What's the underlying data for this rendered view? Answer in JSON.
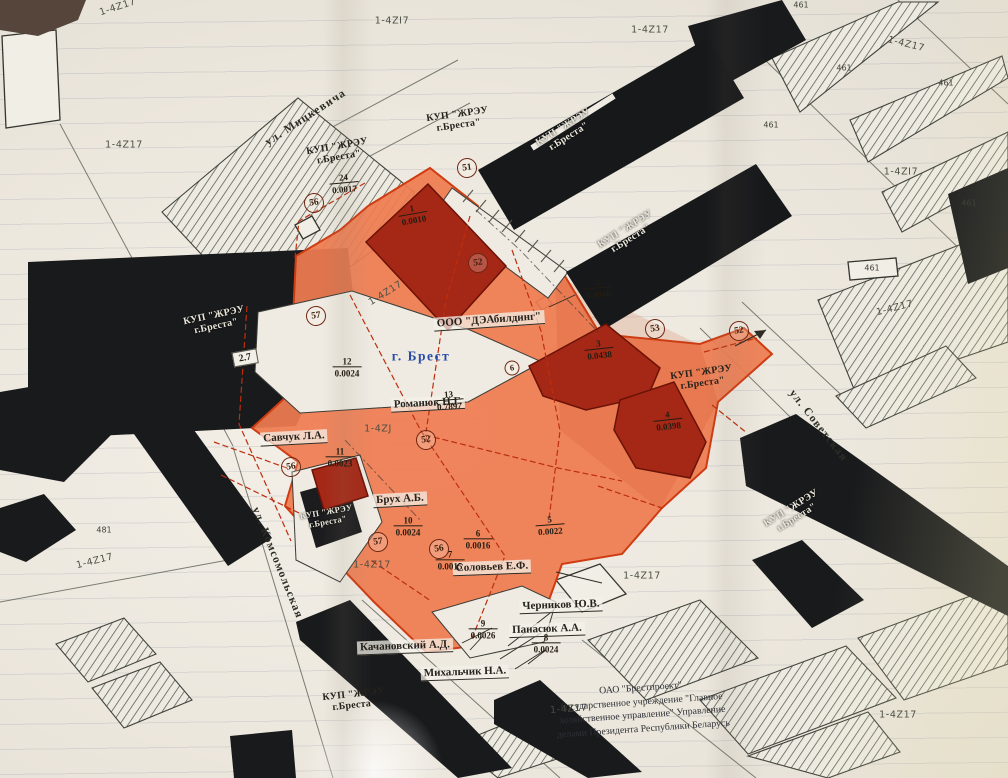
{
  "map": {
    "colors": {
      "paper": "#ece8df",
      "zone_orange": "#ef7c51",
      "zone_building_red": "#a52716",
      "black_building": "#17181a",
      "boundary_red": "#cf3c12",
      "city_blue": "#2a4da8"
    },
    "street_names": [
      {
        "text": "ул. Мицкевича",
        "x": 306,
        "y": 118,
        "rot": -33
      },
      {
        "text": "ул. Комсомольская",
        "x": 277,
        "y": 563,
        "rot": 68
      },
      {
        "text": "ул. Советская",
        "x": 818,
        "y": 426,
        "rot": 52
      }
    ],
    "kup_labels": [
      {
        "text": "КУП \"ЖРЭУ\nг.Бреста\"",
        "x": 338,
        "y": 152,
        "rot": -10,
        "on": "paper"
      },
      {
        "text": "КУП \"ЖРЭУ\nг.Бреста\"",
        "x": 458,
        "y": 120,
        "rot": -8,
        "on": "paper"
      },
      {
        "text": "КУП \"ЖРЭУ\nг.Бреста\"",
        "x": 566,
        "y": 132,
        "rot": -32,
        "on": "black"
      },
      {
        "text": "КУП \"ЖРЭУ\nг.Бреста\"",
        "x": 628,
        "y": 234,
        "rot": -32,
        "on": "black"
      },
      {
        "text": "КУП \"ЖРЭУ\nг.Бреста\"",
        "x": 215,
        "y": 321,
        "rot": -12,
        "on": "black"
      },
      {
        "text": "КУП \"ЖРЭУ\nг.Бреста\"",
        "x": 702,
        "y": 378,
        "rot": -8,
        "on": "paper"
      },
      {
        "text": "КУП \"ЖРЭУ\nг.Бреста\"",
        "x": 794,
        "y": 513,
        "rot": -32,
        "on": "black"
      },
      {
        "text": "КУП \"ЖРЭУ\nг.Бреста\"",
        "x": 327,
        "y": 517,
        "rot": -10,
        "on": "black",
        "small": true
      },
      {
        "text": "КУП \"ЖРЭУ\nг.Бреста\"",
        "x": 354,
        "y": 700,
        "rot": -6,
        "on": "paper"
      }
    ],
    "owner_labels": [
      {
        "text": "ООО \"ДЭАбилдинг\"",
        "x": 489,
        "y": 321,
        "rot": -4
      },
      {
        "text": "Романюк Н.Г.",
        "x": 428,
        "y": 404,
        "rot": -3
      },
      {
        "text": "Савчук Л.А.",
        "x": 294,
        "y": 438,
        "rot": -3
      },
      {
        "text": "Брух А.Б.",
        "x": 400,
        "y": 500,
        "rot": -3
      },
      {
        "text": "Соловьев Е.Ф.",
        "x": 492,
        "y": 568,
        "rot": -2
      },
      {
        "text": "Черников Ю.В.",
        "x": 561,
        "y": 606,
        "rot": -2
      },
      {
        "text": "Панасюк А.А.",
        "x": 547,
        "y": 630,
        "rot": -2
      },
      {
        "text": "Качановский А.Д.",
        "x": 405,
        "y": 647,
        "rot": -2
      },
      {
        "text": "Михальчик Н.А.",
        "x": 465,
        "y": 673,
        "rot": -2
      }
    ],
    "city_label": {
      "text": "г. Брест",
      "x": 421,
      "y": 356,
      "rot": 0
    },
    "zone_codes": [
      {
        "text": "1-4Z17",
        "x": 118,
        "y": 8,
        "rot": -18
      },
      {
        "text": "1-4ZI7",
        "x": 392,
        "y": 22,
        "rot": 0
      },
      {
        "text": "1-4Z17",
        "x": 650,
        "y": 31,
        "rot": 0
      },
      {
        "text": "1-4Z17",
        "x": 906,
        "y": 45,
        "rot": 14
      },
      {
        "text": "1-4Z17",
        "x": 124,
        "y": 146,
        "rot": 0
      },
      {
        "text": "1-4ZI7",
        "x": 901,
        "y": 173,
        "rot": 0
      },
      {
        "text": "1-4Z17",
        "x": 386,
        "y": 294,
        "rot": -32
      },
      {
        "text": "1-4Z17",
        "x": 895,
        "y": 309,
        "rot": -14
      },
      {
        "text": "1-4ZJ",
        "x": 378,
        "y": 430,
        "rot": 0
      },
      {
        "text": "1-4Z17",
        "x": 95,
        "y": 562,
        "rot": -14
      },
      {
        "text": "1-4Z17",
        "x": 372,
        "y": 566,
        "rot": 0
      },
      {
        "text": "1-4Z17",
        "x": 642,
        "y": 577,
        "rot": 0
      },
      {
        "text": "1-4Z17",
        "x": 569,
        "y": 710,
        "rot": -4
      },
      {
        "text": "1-4Z17",
        "x": 898,
        "y": 716,
        "rot": 0
      }
    ],
    "small_codes": [
      {
        "text": "461",
        "x": 801,
        "y": 6
      },
      {
        "text": "461",
        "x": 844,
        "y": 69
      },
      {
        "text": "461",
        "x": 946,
        "y": 84
      },
      {
        "text": "461",
        "x": 771,
        "y": 126
      },
      {
        "text": "461",
        "x": 969,
        "y": 204
      },
      {
        "text": "461",
        "x": 872,
        "y": 269
      },
      {
        "text": "481",
        "x": 104,
        "y": 531
      }
    ],
    "point_height": {
      "text": "2.7",
      "x": 245,
      "y": 358,
      "rot": -10
    },
    "parcel_fractions": [
      {
        "num": "24",
        "value": "0.0017",
        "x": 344,
        "y": 184,
        "rot": -5
      },
      {
        "num": "1",
        "value": "0.0010",
        "x": 413,
        "y": 215,
        "rot": -10
      },
      {
        "num": "2",
        "value": "0.0040",
        "x": 598,
        "y": 289,
        "rot": -5
      },
      {
        "num": "3",
        "value": "0.0438",
        "x": 599,
        "y": 350,
        "rot": -6
      },
      {
        "num": "4",
        "value": "0.0398",
        "x": 668,
        "y": 421,
        "rot": -6
      },
      {
        "num": "12",
        "value": "0.0024",
        "x": 347,
        "y": 368,
        "rot": 0
      },
      {
        "num": "13",
        "value": "0.7897",
        "x": 449,
        "y": 401,
        "rot": -4
      },
      {
        "num": "11",
        "value": "0.0023",
        "x": 340,
        "y": 458,
        "rot": 0
      },
      {
        "num": "10",
        "value": "0.0024",
        "x": 408,
        "y": 527,
        "rot": 0
      },
      {
        "num": "6",
        "value": "0.0016",
        "x": 478,
        "y": 540,
        "rot": 0
      },
      {
        "num": "5",
        "value": "0.0022",
        "x": 550,
        "y": 526,
        "rot": -4
      },
      {
        "num": "7",
        "value": "0.0015",
        "x": 450,
        "y": 561,
        "rot": 0
      },
      {
        "num": "9",
        "value": "0.0026",
        "x": 483,
        "y": 630,
        "rot": 0
      },
      {
        "num": "8",
        "value": "0.0024",
        "x": 546,
        "y": 644,
        "rot": 0
      }
    ],
    "circled_points": [
      {
        "n": "56",
        "x": 314,
        "y": 203
      },
      {
        "n": "51",
        "x": 467,
        "y": 168
      },
      {
        "n": "52",
        "x": 478,
        "y": 263
      },
      {
        "n": "57",
        "x": 316,
        "y": 316
      },
      {
        "n": "53",
        "x": 655,
        "y": 329
      },
      {
        "n": "52",
        "x": 739,
        "y": 331
      },
      {
        "n": "52",
        "x": 426,
        "y": 440
      },
      {
        "n": "6",
        "x": 512,
        "y": 368,
        "small": true
      },
      {
        "n": "56",
        "x": 291,
        "y": 467
      },
      {
        "n": "57",
        "x": 378,
        "y": 542
      },
      {
        "n": "56",
        "x": 439,
        "y": 549
      }
    ],
    "org_block": {
      "x": 642,
      "y": 709,
      "rot": -4,
      "lines": [
        "ОАО \"Брестпроект\"",
        "Государственное учреждение \"Главное",
        "хозяйственное управление\" Управление",
        "делами Президента Республики Беларусь"
      ]
    }
  }
}
